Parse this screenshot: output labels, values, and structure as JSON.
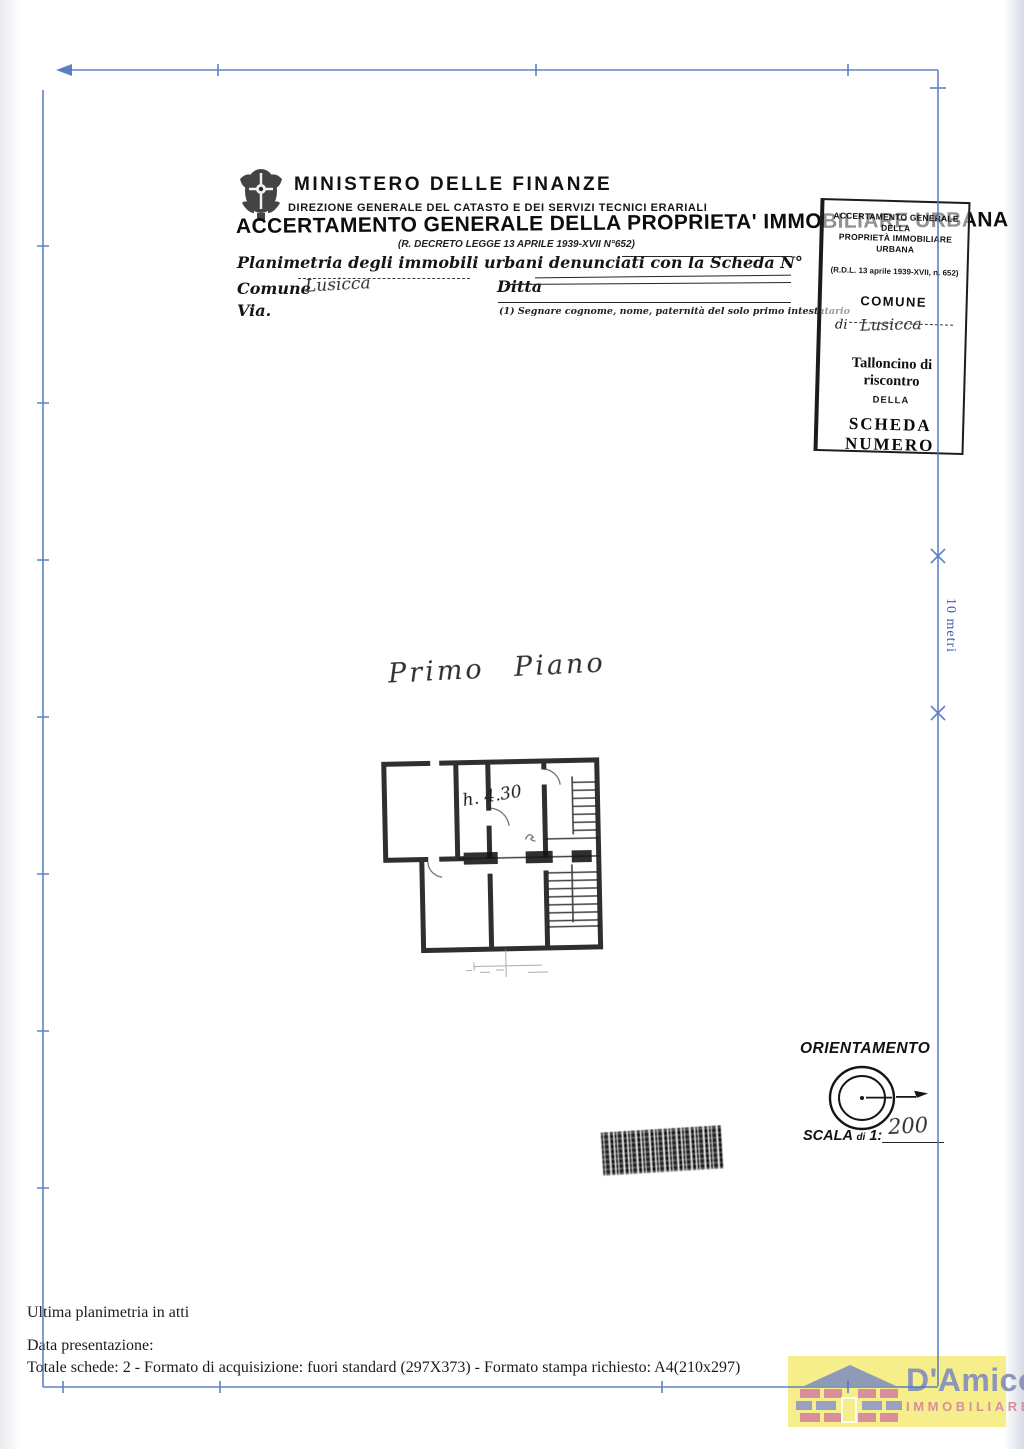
{
  "frame": {
    "color": "#4f74bf"
  },
  "header": {
    "ministry": "MINISTERO DELLE FINANZE",
    "direction": "DIREZIONE GENERALE DEL CATASTO E DEI SERVIZI TECNICI ERARIALI",
    "title": "ACCERTAMENTO GENERALE DELLA PROPRIETA' IMMOBILIARE URBANA",
    "decree": "(R. DECRETO LEGGE 13 APRILE 1939-XVII N°652)",
    "planimetria_line": "Planimetria degli immobili urbani denunciati con la Scheda N°",
    "comune_label": "Comune",
    "comune_value_handwritten": "Lusicca",
    "ditta_label": "Ditta",
    "via_label": "Via.",
    "footnote": "(1) Segnare cognome, nome, paternità del solo primo intestatario"
  },
  "talloncino": {
    "line1": "ACCERTAMENTO GENERALE DELLA",
    "line2": "PROPRIETÀ IMMOBILIARE URBANA",
    "decree": "(R.D.L. 13 aprile 1939-XVII, n. 652)",
    "comune": "COMUNE",
    "di_label": "di",
    "di_value_handwritten": "Lusicca",
    "riscontro": "Talloncino di riscontro",
    "della": "DELLA",
    "scheda": "SCHEDA NUMERO"
  },
  "plan": {
    "floor_label": "Primo Piano",
    "height_note": "h. 4.30"
  },
  "scale_bar": {
    "label": "10 metri"
  },
  "orientation": {
    "title": "ORIENTAMENTO",
    "scala_word": "SCALA",
    "scala_di": "di",
    "scala_one": "1:",
    "scala_value_handwritten": "200"
  },
  "footer": {
    "line1": "Ultima planimetria in atti",
    "line2": "Data presentazione:",
    "line3": "Totale schede: 2 - Formato di acquisizione: fuori standard (297X373) - Formato stampa richiesto: A4(210x297)"
  },
  "logo": {
    "name": "D'Amico",
    "subtitle": "IMMOBILIARE",
    "bg": "#f6ee8b",
    "name_color": "#8d96ba",
    "subtitle_color": "#d78f9e"
  }
}
